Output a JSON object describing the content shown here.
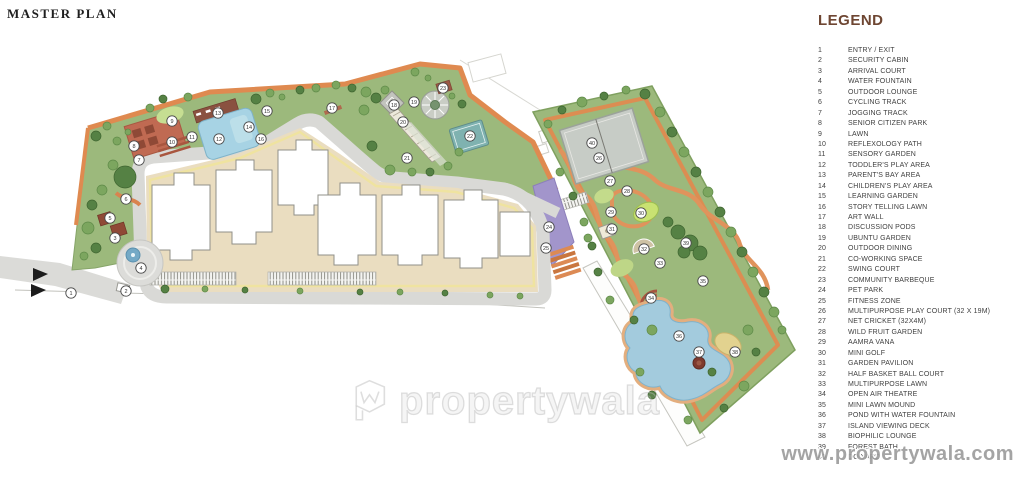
{
  "page": {
    "title": "MASTER PLAN"
  },
  "legend": {
    "title": "LEGEND",
    "items": [
      {
        "n": "1",
        "label": "ENTRY / EXIT"
      },
      {
        "n": "2",
        "label": "SECURITY CABIN"
      },
      {
        "n": "3",
        "label": "ARRIVAL COURT"
      },
      {
        "n": "4",
        "label": "WATER FOUNTAIN"
      },
      {
        "n": "5",
        "label": "OUTDOOR LOUNGE"
      },
      {
        "n": "6",
        "label": "CYCLING TRACK"
      },
      {
        "n": "7",
        "label": "JOGGING TRACK"
      },
      {
        "n": "8",
        "label": "SENIOR CITIZEN PARK"
      },
      {
        "n": "9",
        "label": "LAWN"
      },
      {
        "n": "10",
        "label": "REFLEXOLOGY PATH"
      },
      {
        "n": "11",
        "label": "SENSORY GARDEN"
      },
      {
        "n": "12",
        "label": "TODDLER'S PLAY AREA"
      },
      {
        "n": "13",
        "label": "PARENT'S BAY AREA"
      },
      {
        "n": "14",
        "label": "CHILDREN'S PLAY AREA"
      },
      {
        "n": "15",
        "label": "LEARNING GARDEN"
      },
      {
        "n": "16",
        "label": "STORY TELLING LAWN"
      },
      {
        "n": "17",
        "label": "ART WALL"
      },
      {
        "n": "18",
        "label": "DISCUSSION PODS"
      },
      {
        "n": "19",
        "label": "UBUNTU GARDEN"
      },
      {
        "n": "20",
        "label": "OUTDOOR DINING"
      },
      {
        "n": "21",
        "label": "CO-WORKING SPACE"
      },
      {
        "n": "22",
        "label": "SWING COURT"
      },
      {
        "n": "23",
        "label": "COMMUNITY BARBEQUE"
      },
      {
        "n": "24",
        "label": "PET PARK"
      },
      {
        "n": "25",
        "label": "FITNESS ZONE"
      },
      {
        "n": "26",
        "label": "MULTIPURPOSE PLAY COURT (32 X 19M)"
      },
      {
        "n": "27",
        "label": "NET CRICKET (32X4M)"
      },
      {
        "n": "28",
        "label": "WILD FRUIT GARDEN"
      },
      {
        "n": "29",
        "label": "AAMRA VANA"
      },
      {
        "n": "30",
        "label": "MINI GOLF"
      },
      {
        "n": "31",
        "label": "GARDEN PAVILION"
      },
      {
        "n": "32",
        "label": "HALF BASKET BALL COURT"
      },
      {
        "n": "33",
        "label": "MULTIPURPOSE LAWN"
      },
      {
        "n": "34",
        "label": "OPEN AIR THEATRE"
      },
      {
        "n": "35",
        "label": "MINI LAWN MOUND"
      },
      {
        "n": "36",
        "label": "POND WITH WATER FOUNTAIN"
      },
      {
        "n": "37",
        "label": "ISLAND VIEWING DECK"
      },
      {
        "n": "38",
        "label": "BIOPHILIC LOUNGE"
      },
      {
        "n": "39",
        "label": "FOREST BATH"
      },
      {
        "n": "40",
        "label": "DO YARD"
      }
    ]
  },
  "plan": {
    "markers": [
      {
        "n": "1",
        "x": 71,
        "y": 293
      },
      {
        "n": "2",
        "x": 126,
        "y": 291
      },
      {
        "n": "3",
        "x": 115,
        "y": 238
      },
      {
        "n": "4",
        "x": 141,
        "y": 268
      },
      {
        "n": "5",
        "x": 110,
        "y": 218
      },
      {
        "n": "6",
        "x": 126,
        "y": 199
      },
      {
        "n": "7",
        "x": 139,
        "y": 160
      },
      {
        "n": "8",
        "x": 134,
        "y": 146
      },
      {
        "n": "9",
        "x": 172,
        "y": 121
      },
      {
        "n": "10",
        "x": 172,
        "y": 142
      },
      {
        "n": "11",
        "x": 192,
        "y": 137
      },
      {
        "n": "12",
        "x": 219,
        "y": 139
      },
      {
        "n": "13",
        "x": 218,
        "y": 113
      },
      {
        "n": "14",
        "x": 249,
        "y": 127
      },
      {
        "n": "15",
        "x": 267,
        "y": 111
      },
      {
        "n": "16",
        "x": 261,
        "y": 139
      },
      {
        "n": "17",
        "x": 332,
        "y": 108
      },
      {
        "n": "18",
        "x": 394,
        "y": 105
      },
      {
        "n": "19",
        "x": 414,
        "y": 102
      },
      {
        "n": "20",
        "x": 403,
        "y": 122
      },
      {
        "n": "21",
        "x": 407,
        "y": 158
      },
      {
        "n": "22",
        "x": 470,
        "y": 136
      },
      {
        "n": "23",
        "x": 443,
        "y": 88
      },
      {
        "n": "24",
        "x": 549,
        "y": 227
      },
      {
        "n": "25",
        "x": 546,
        "y": 248
      },
      {
        "n": "26",
        "x": 599,
        "y": 158
      },
      {
        "n": "27",
        "x": 610,
        "y": 181
      },
      {
        "n": "28",
        "x": 627,
        "y": 191
      },
      {
        "n": "29",
        "x": 611,
        "y": 212
      },
      {
        "n": "30",
        "x": 641,
        "y": 213
      },
      {
        "n": "31",
        "x": 612,
        "y": 229
      },
      {
        "n": "32",
        "x": 644,
        "y": 249
      },
      {
        "n": "33",
        "x": 660,
        "y": 263
      },
      {
        "n": "34",
        "x": 651,
        "y": 298
      },
      {
        "n": "35",
        "x": 703,
        "y": 281
      },
      {
        "n": "36",
        "x": 679,
        "y": 336
      },
      {
        "n": "37",
        "x": 699,
        "y": 352
      },
      {
        "n": "38",
        "x": 735,
        "y": 352
      },
      {
        "n": "39",
        "x": 686,
        "y": 243
      },
      {
        "n": "40",
        "x": 592,
        "y": 143
      }
    ]
  },
  "watermark": {
    "center_text": "propertywala",
    "corner_text": "www.propertywala.com"
  },
  "colors": {
    "accent_orange": "#DF8A50",
    "site_green": "#9CB97C",
    "lawn_green": "#C6DE92",
    "tree_green": "#558144",
    "water_blue": "#A3CBDD",
    "pool_blue": "#A7D3E4",
    "road_gray": "#D9D9D6",
    "court_gray": "#C7CCC6",
    "building_white": "#FFFFFF",
    "courtyard_beige": "#EADDC0",
    "track_yellow": "#EFE3A0",
    "terracotta": "#B65C45",
    "pet_park_purple": "#A295CB",
    "legend_title_brown": "#6E4632",
    "legend_text": "#3F3F3F",
    "watermark_gray": "#9B9B9B"
  }
}
